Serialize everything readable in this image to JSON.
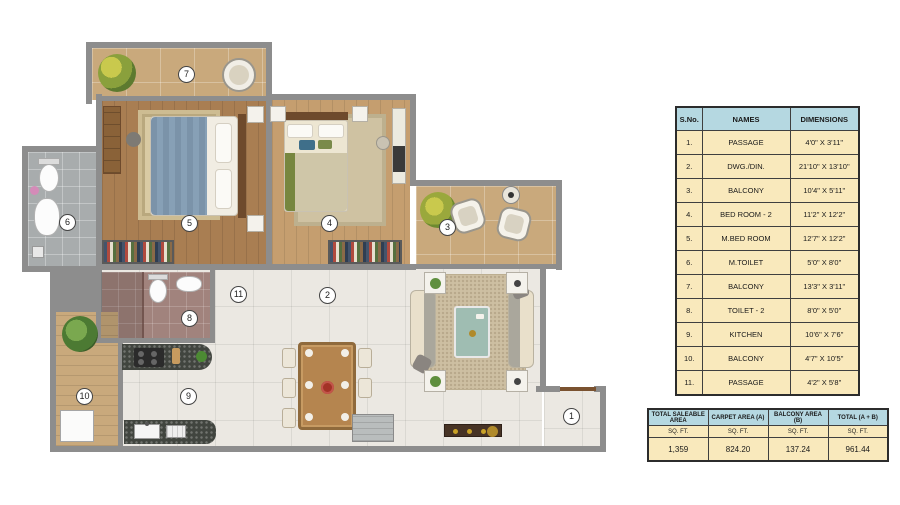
{
  "plan": {
    "markers": [
      "1",
      "2",
      "3",
      "4",
      "5",
      "6",
      "7",
      "8",
      "9",
      "10",
      "11"
    ]
  },
  "rooms_table": {
    "headers": [
      "S.No.",
      "NAMES",
      "DIMENSIONS"
    ],
    "rows": [
      {
        "no": "1.",
        "name": "PASSAGE",
        "dim": "4'0\" X 3'11\""
      },
      {
        "no": "2.",
        "name": "DWG./DIN.",
        "dim": "21'10\" X 13'10\""
      },
      {
        "no": "3.",
        "name": "BALCONY",
        "dim": "10'4\" X 5'11\""
      },
      {
        "no": "4.",
        "name": "BED ROOM - 2",
        "dim": "11'2\" X 12'2\""
      },
      {
        "no": "5.",
        "name": "M.BED ROOM",
        "dim": "12'7\" X 12'2\""
      },
      {
        "no": "6.",
        "name": "M.TOILET",
        "dim": "5'0\" X 8'0\""
      },
      {
        "no": "7.",
        "name": "BALCONY",
        "dim": "13'3\" X 3'11\""
      },
      {
        "no": "8.",
        "name": "TOILET - 2",
        "dim": "8'0\" X 5'0\""
      },
      {
        "no": "9.",
        "name": "KITCHEN",
        "dim": "10'6\" X 7'6\""
      },
      {
        "no": "10.",
        "name": "BALCONY",
        "dim": "4'7\" X 10'5\""
      },
      {
        "no": "11.",
        "name": "PASSAGE",
        "dim": "4'2\" X 5'8\""
      }
    ]
  },
  "area_table": {
    "columns": [
      {
        "header": "TOTAL SALEABLE AREA",
        "unit": "SQ. FT.",
        "value": "1,359"
      },
      {
        "header": "CARPET AREA (A)",
        "unit": "SQ. FT.",
        "value": "824.20"
      },
      {
        "header": "BALCONY AREA (B)",
        "unit": "SQ. FT.",
        "value": "137.24"
      },
      {
        "header": "TOTAL (A + B)",
        "unit": "SQ. FT.",
        "value": "961.44"
      }
    ]
  },
  "colors": {
    "table_header_blue": "#b5d8e1",
    "table_row_cream": "#f9e9bc",
    "wall_gray": "#8d8d8d",
    "wood_dark": "#a97e52",
    "wood_light": "#c59e6f",
    "balcony_tile_tan": "#c9a97c",
    "floor_tile_white": "#ebe8e2",
    "toilet_tile_gray": "#a8acad",
    "toilet_tile_mauve": "#a1837d",
    "coffee_table_teal": "#9fbdb2"
  }
}
